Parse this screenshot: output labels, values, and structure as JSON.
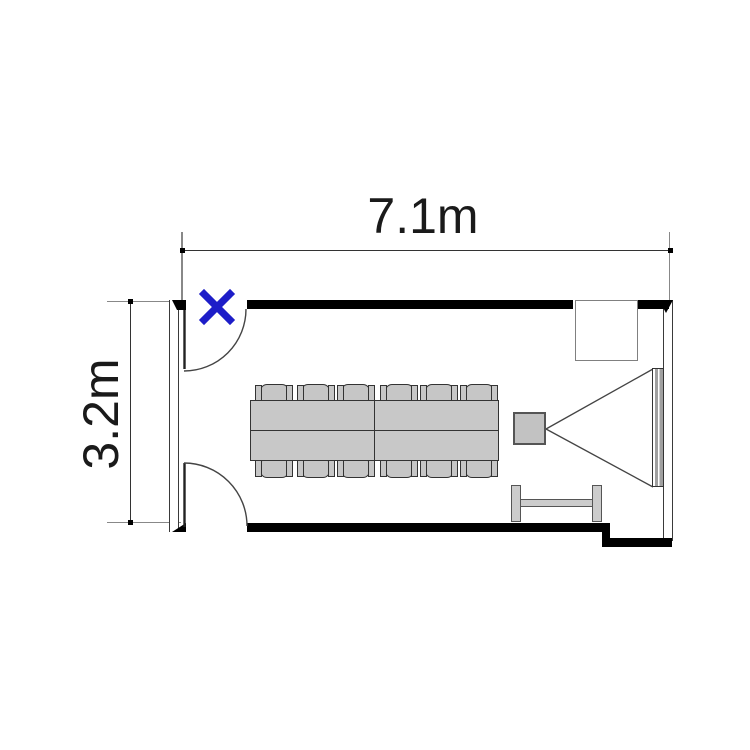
{
  "plan": {
    "width_label": "7.1m",
    "height_label": "3.2m"
  },
  "marker": {
    "symbol": "x",
    "color": "#1d1dc8"
  },
  "colors": {
    "wall": "#000000",
    "furniture_fill": "#c8c8c8",
    "furniture_border": "#333333",
    "screen_fill": "#a0a0a0",
    "dimension_text": "#1a1a1a"
  },
  "furniture": {
    "chair_count": 12,
    "door_count": 2,
    "items": [
      "conference-table",
      "chairs",
      "projector",
      "projection-screen",
      "side-table",
      "wall-cabinet",
      "projection-cone"
    ]
  }
}
